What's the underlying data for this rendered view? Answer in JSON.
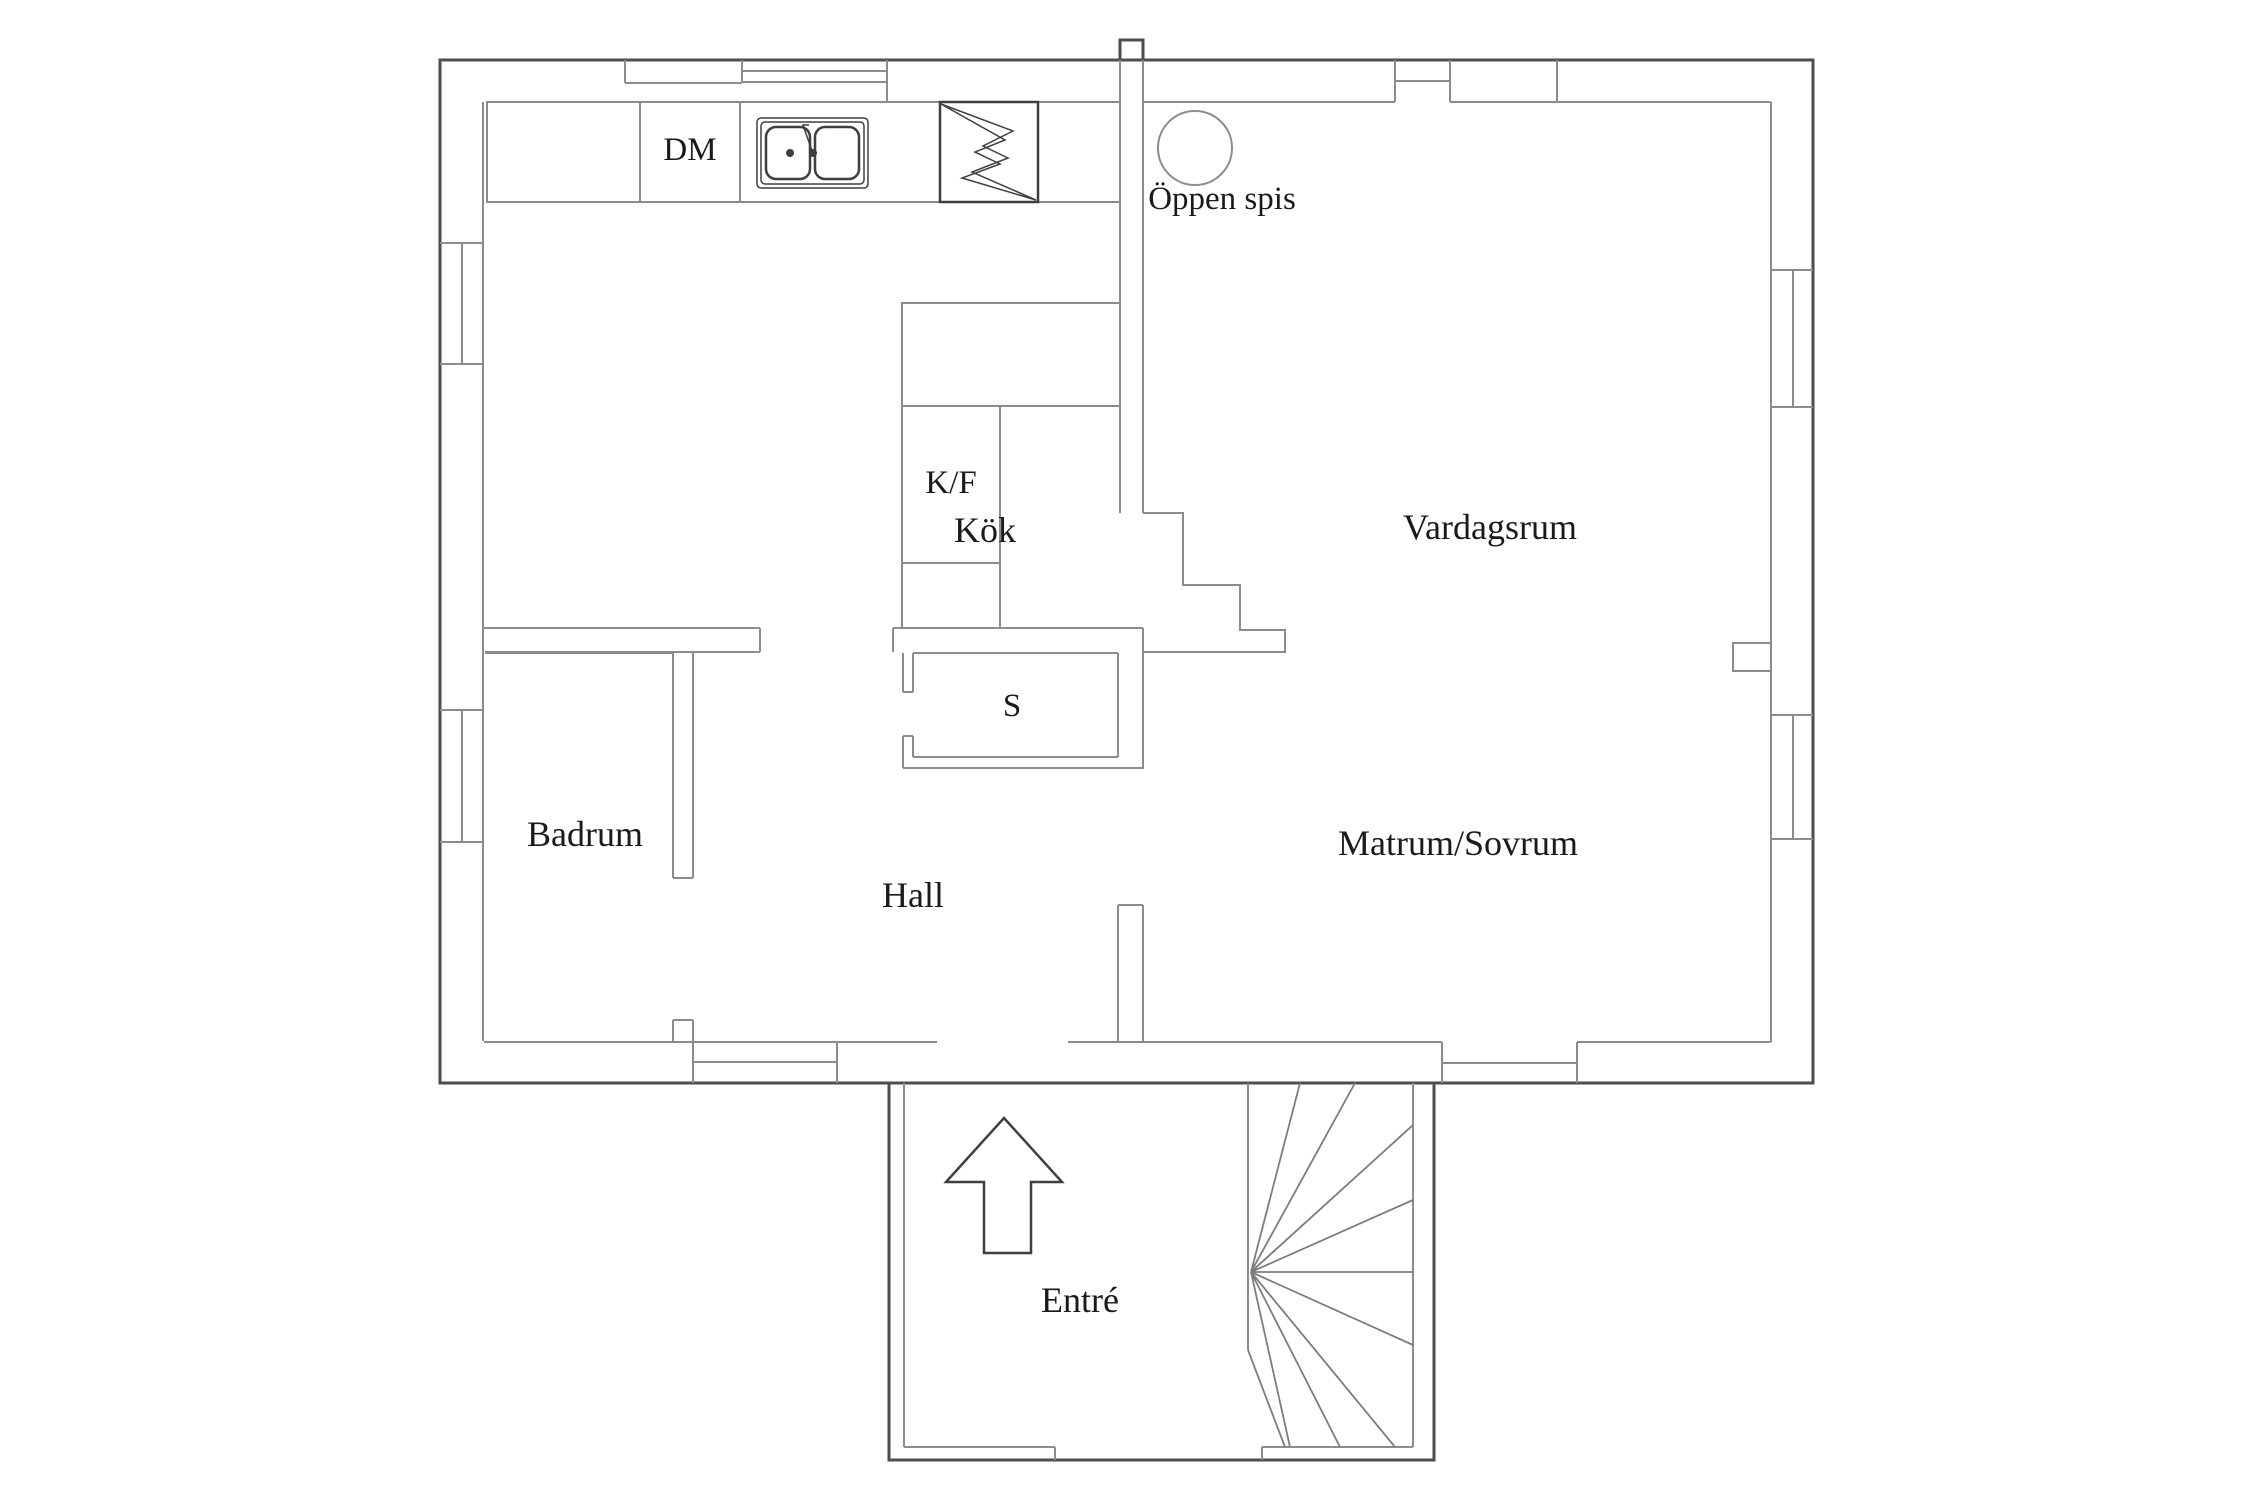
{
  "labels": {
    "kok": "Kök",
    "dm": "DM",
    "oppen_spis": "Öppen spis",
    "kf": "K/F",
    "vardagsrum": "Vardagsrum",
    "s": "S",
    "badrum": "Badrum",
    "matrum_sovrum": "Matrum/Sovrum",
    "hall": "Hall",
    "entre": "Entré"
  },
  "rooms": [
    {
      "id": "kok",
      "label": "Kök"
    },
    {
      "id": "vardagsrum",
      "label": "Vardagsrum"
    },
    {
      "id": "badrum",
      "label": "Badrum"
    },
    {
      "id": "hall",
      "label": "Hall"
    },
    {
      "id": "matrum_sovrum",
      "label": "Matrum/Sovrum"
    },
    {
      "id": "entre",
      "label": "Entré"
    }
  ],
  "fixtures": [
    {
      "id": "dm",
      "label": "DM",
      "meaning": "dishwasher"
    },
    {
      "id": "sink",
      "icon": "double-sink-icon"
    },
    {
      "id": "stove",
      "icon": "stove-lightning-icon"
    },
    {
      "id": "oppen_spis",
      "label": "Öppen spis",
      "icon": "fireplace-circle-icon"
    },
    {
      "id": "kf",
      "label": "K/F",
      "meaning": "fridge/freezer"
    },
    {
      "id": "s",
      "label": "S",
      "meaning": "closet"
    },
    {
      "id": "stairs",
      "icon": "winder-stairs-icon"
    },
    {
      "id": "entry_arrow",
      "icon": "entry-arrow-icon"
    }
  ],
  "colors": {
    "background": "#ffffff",
    "wall_outer": "#4d4d4d",
    "wall_inner": "#8c8c8c",
    "fixture": "#3f3f3f",
    "stair": "#7d7d7d",
    "text": "#1a1a1a"
  }
}
